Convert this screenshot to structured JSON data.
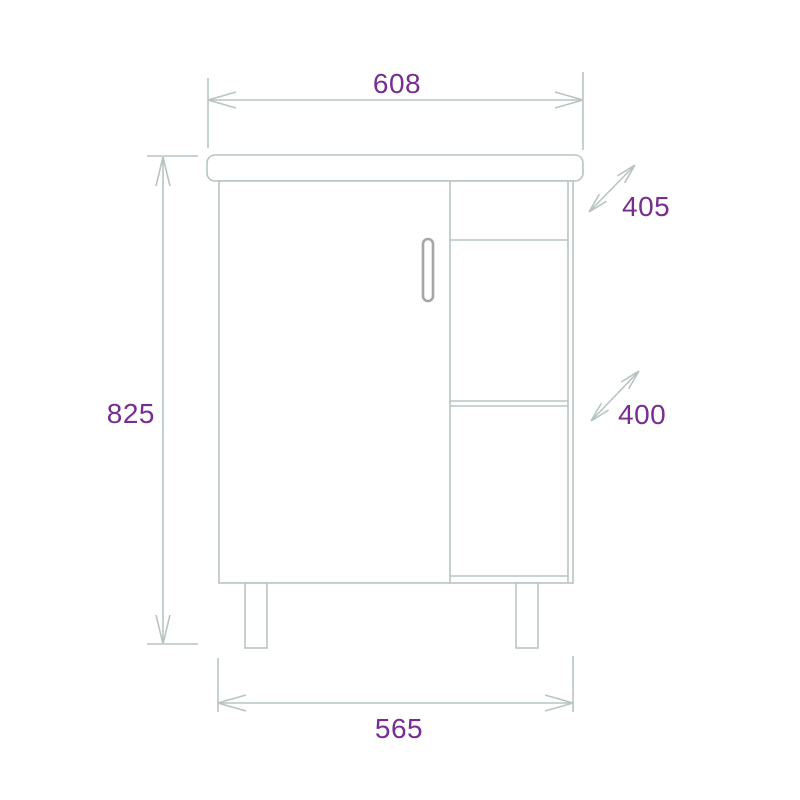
{
  "drawing": {
    "labels": {
      "top_width": "608",
      "overall_height": "825",
      "upper_depth": "405",
      "lower_depth": "400",
      "bottom_width": "565"
    },
    "colors": {
      "line": "#b8c5bf",
      "dimension_text": "#772d91",
      "handle": "#a6a6a6",
      "background": "#ffffff"
    }
  }
}
